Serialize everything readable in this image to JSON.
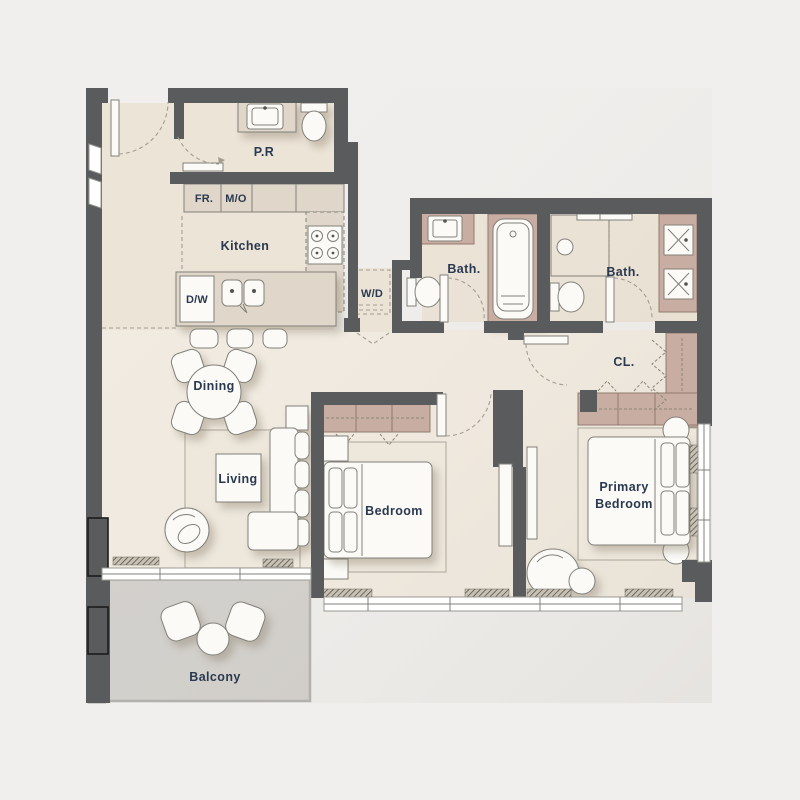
{
  "palette": {
    "bg": "#f0efed",
    "wall": "#5a5b5d",
    "floor": "#f1ebe1",
    "floorTan": "#ece4d7",
    "cabinet": "#e0d7ca",
    "fixture": "#fbfaf7",
    "wardrobe": "#c8aea2",
    "wardrobeLine": "#937b6e",
    "rug": "#ede7dc",
    "rugLine": "#b7b1a5",
    "balcony": "#d3d1cd",
    "line": "#82807a",
    "dash": "#a49d90",
    "label": "#2a3950",
    "glassLine": "#9a9891"
  },
  "rooms": {
    "powder_room": {
      "label": "P.R"
    },
    "kitchen": {
      "label": "Kitchen"
    },
    "dining": {
      "label": "Dining"
    },
    "living": {
      "label": "Living"
    },
    "bedroom": {
      "label": "Bedroom"
    },
    "primary_bedroom": {
      "line1": "Primary",
      "line2": "Bedroom"
    },
    "bath_1": {
      "label": "Bath."
    },
    "bath_2": {
      "label": "Bath."
    },
    "closet": {
      "label": "CL."
    },
    "laundry": {
      "label": "W/D"
    },
    "balcony": {
      "label": "Balcony"
    }
  },
  "appliances": {
    "fridge": "FR.",
    "microwave_oven": "M/O",
    "dishwasher": "D/W"
  }
}
